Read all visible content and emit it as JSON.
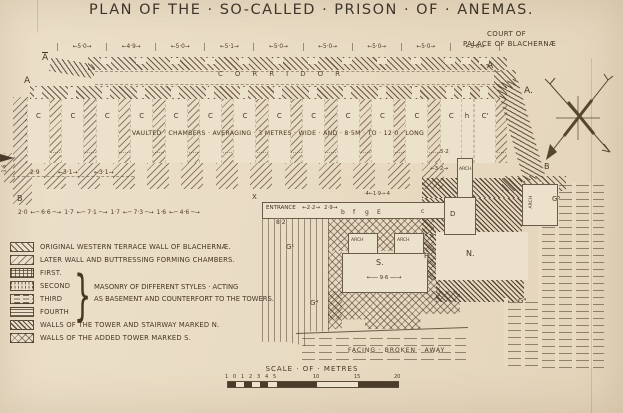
{
  "title": "PLAN OF THE · SO-CALLED · PRISON · OF · ANEMAS.",
  "court": {
    "line1": "COURT OF",
    "line2": "PALACE OF BLACHERNÆ"
  },
  "compass": {
    "icon": "compass-rose"
  },
  "plan": {
    "section_a_top_left": "A",
    "section_a_left": "A",
    "section_a_right": "A",
    "section_a_right2": "A.",
    "top_dimensions": [
      "←5·0→",
      "←4·9→",
      "←5·0→",
      "←5·1→",
      "←5·0→",
      "←5·0→",
      "←5·0→",
      "←5·0→",
      "←5·0→"
    ],
    "corridor": "CORRIDOR",
    "chamber_labels": [
      "C",
      "C",
      "C",
      "C",
      "C",
      "C",
      "C",
      "C",
      "C",
      "C",
      "C",
      "C",
      "C",
      "h",
      "C'"
    ],
    "note": "VAULTED · CHAMBERS · AVERAGING · 3 METRES · WIDE · AND · 8·5M · TO · 12·0 · LONG",
    "left_dims": [
      "2·9",
      "←3·1→",
      "←3·1→"
    ],
    "left_dim_vertical": "1·6",
    "bottom_dims": [
      "2·0",
      "←─ 6·6 ─→",
      "1·7",
      "←─ 7·1 ─→",
      "1·7",
      "←─ 7·3 ─→",
      "1·6",
      "←─ 4·6 ─→"
    ],
    "dim_5_2": "5·2",
    "dim_3_2": "←3·2→",
    "dim_1_9": "·4←1·9→·4",
    "entrance_label": "ENTRANCE",
    "dim_2_2": "←2·2→",
    "dim_2_9": "2·9→",
    "dim_8_2": "8·2",
    "dim_9_6": "←── 9·6 ──→",
    "letters": {
      "b": "b",
      "f": "f",
      "g": "g",
      "e": "E",
      "c": "c",
      "d": "D",
      "h": "H",
      "x": "X"
    },
    "tower_s": "S.",
    "tower_n": "N.",
    "b_left": "B",
    "b_right": "B",
    "g1": "G¹",
    "g4a": "G⁴",
    "g4b": "G⁴",
    "g5": "G⁵",
    "arch": "ARCH",
    "facing": "FACING · BROKEN · AWAY"
  },
  "legend": {
    "items": [
      {
        "swatch": "p-hatchA",
        "label": "ORIGINAL WESTERN TERRACE WALL OF BLACHERNÆ."
      },
      {
        "swatch": "p-hatchB",
        "label": "LATER WALL AND BUTTRESSING FORMING CHAMBERS."
      },
      {
        "swatch": "p-brick",
        "label": "FIRST."
      },
      {
        "swatch": "p-vdash",
        "label": "SECOND"
      },
      {
        "swatch": "p-hdash2",
        "label": "THIRD"
      },
      {
        "swatch": "p-hlines",
        "label": "FOURTH"
      },
      {
        "swatch": "p-dense",
        "label": "WALLS OF THE TOWER AND STAIRWAY MARKED N."
      },
      {
        "swatch": "p-cross",
        "label": "WALLS OF THE ADDED TOWER MARKED S."
      }
    ],
    "brace": "}",
    "masonry_note_line1": "MASONRY OF DIFFERENT STYLES · ACTING",
    "masonry_note_line2": "AS BASEMENT AND COUNTERFORT TO THE TOWERS."
  },
  "scale": {
    "title": "SCALE · OF · METRES",
    "ticks": [
      "1",
      "0",
      "1",
      "2",
      "3",
      "4",
      "5",
      "10",
      "15",
      "20"
    ]
  }
}
